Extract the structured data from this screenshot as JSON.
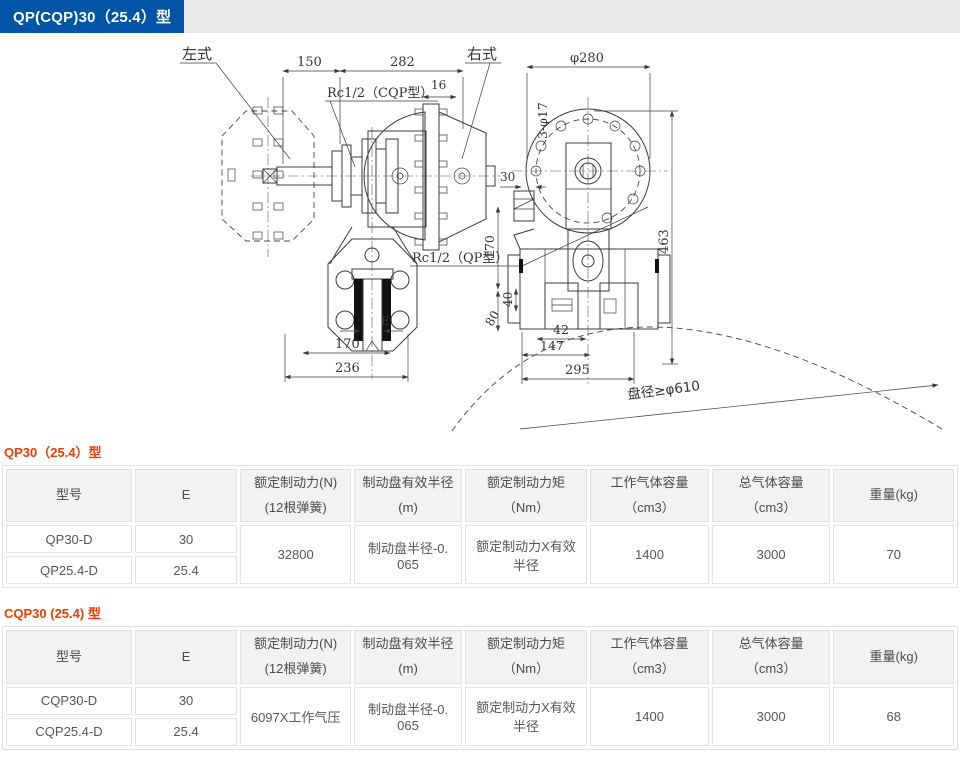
{
  "page": {
    "badge_title": "QP(CQP)30（25.4）型"
  },
  "drawing": {
    "labels": {
      "left_type": "左式",
      "right_type": "右式",
      "rc_cqp": "Rc1/2（CQP型）",
      "rc_qp": "Rc1/2（QP型）",
      "disc_note": "盘径≥φ610",
      "holes": "3-φ17"
    },
    "dims": {
      "w150": "150",
      "w282": "282",
      "w16": "16",
      "e": "E",
      "w170": "170",
      "w236": "236",
      "d280": "φ280",
      "w30": "30",
      "h463": "463",
      "h170": "170",
      "h40": "40",
      "h80": "80",
      "w42": "42",
      "w147": "147",
      "w295": "295"
    }
  },
  "tables": [
    {
      "section_title": "QP30（25.4）型",
      "headers": [
        "型号",
        "E",
        "额定制动力(N) (12根弹簧)",
        "制动盘有效半径(m)",
        "额定制动力矩（Nm）",
        "工作气体容量（cm3）",
        "总气体容量（cm3）",
        "重量(kg)"
      ],
      "rows": [
        {
          "model": "QP30-D",
          "e": "30"
        },
        {
          "model": "QP25.4-D",
          "e": "25.4"
        }
      ],
      "merged": {
        "force": "32800",
        "radius": "制动盘半径-0. 065",
        "torque": "额定制动力X有效半径",
        "work_volume": "1400",
        "total_volume": "3000",
        "weight": "70"
      }
    },
    {
      "section_title": "CQP30 (25.4) 型",
      "headers": [
        "型号",
        "E",
        "额定制动力(N) (12根弹簧)",
        "制动盘有效半径(m)",
        "额定制动力矩（Nm）",
        "工作气体容量（cm3）",
        "总气体容量（cm3）",
        "重量(kg)"
      ],
      "rows": [
        {
          "model": "CQP30-D",
          "e": "30"
        },
        {
          "model": "CQP25.4-D",
          "e": "25.4"
        }
      ],
      "merged": {
        "force": "6097X工作气压",
        "radius": "制动盘半径-0. 065",
        "torque": "额定制动力X有效半径",
        "work_volume": "1400",
        "total_volume": "3000",
        "weight": "68"
      }
    }
  ]
}
